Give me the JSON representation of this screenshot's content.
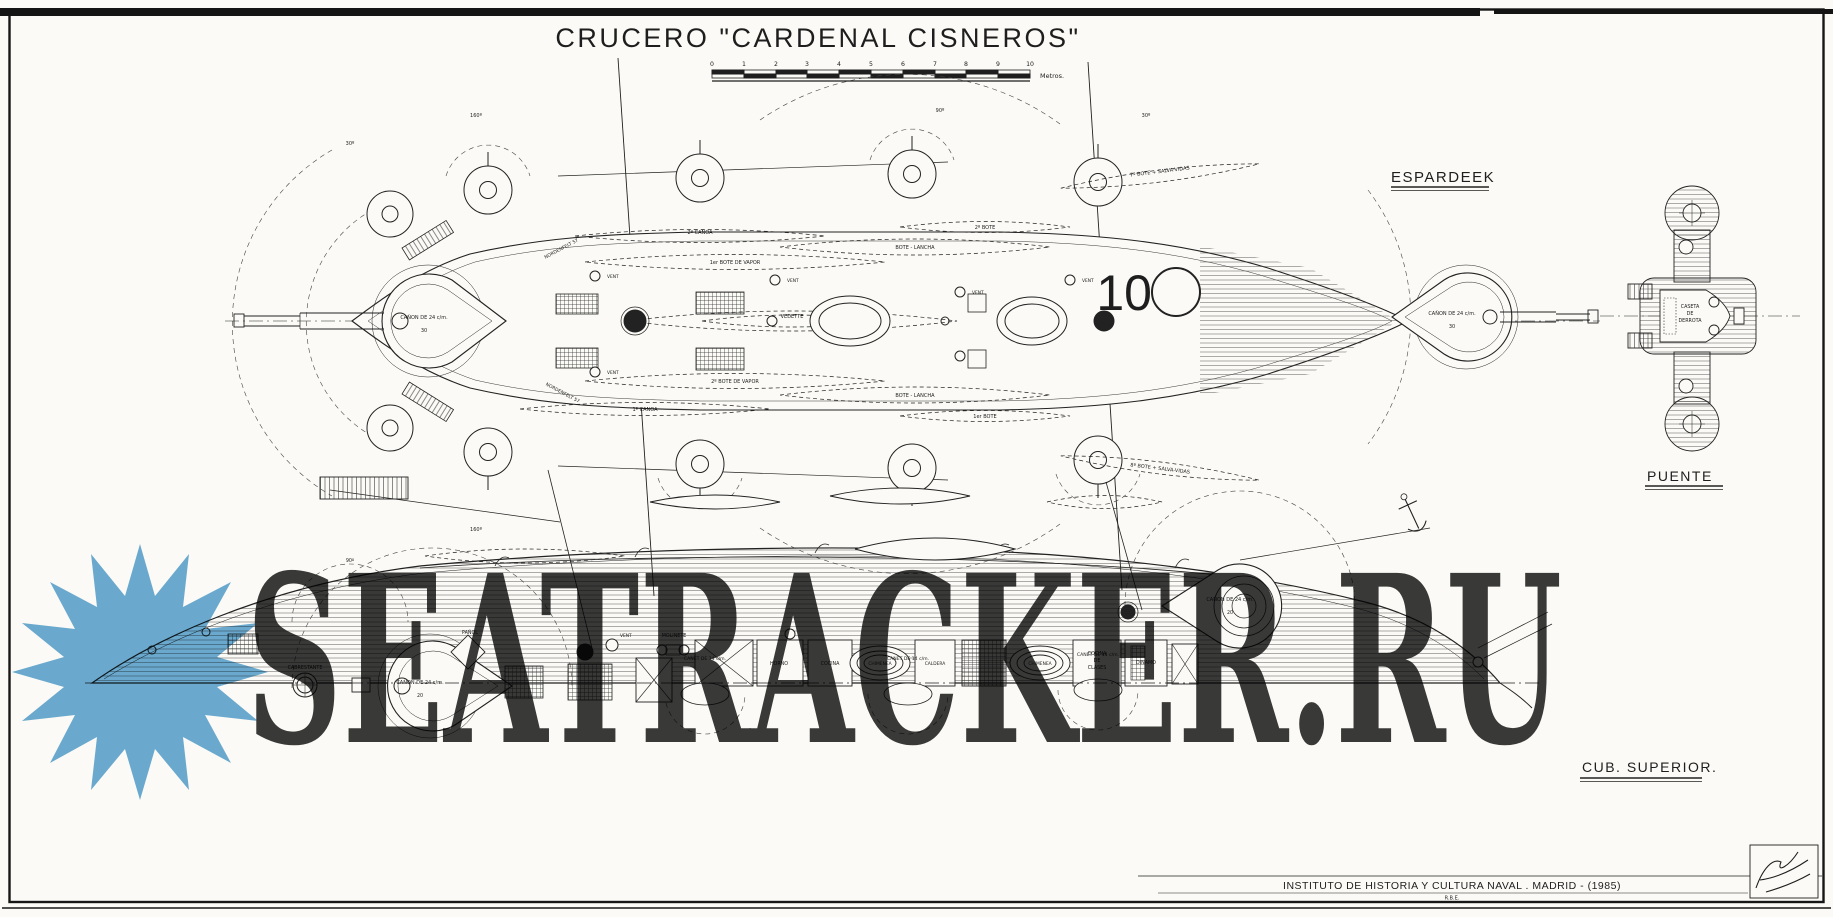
{
  "title": "CRUCERO \"CARDENAL CISNEROS\"",
  "scale_bar": {
    "ticks": [
      "0",
      "1",
      "2",
      "3",
      "4",
      "5",
      "6",
      "7",
      "8",
      "9",
      "10"
    ],
    "unit": "Metros."
  },
  "plan_labels": {
    "espardeek": "ESPARDEEK",
    "puente": "PUENTE",
    "cub_superior": "CUB. SUPERIOR."
  },
  "annotations": {
    "canon24": "CAÑON DE 24 c/m.",
    "g30": "30",
    "g20": "20",
    "canoa1": "1ª CANOA",
    "canoa2": "2ª CANOA",
    "botevapor1": "1er BOTE DE VAPOR",
    "botevapor2": "2º BOTE DE VAPOR",
    "vedette": "VEDETTE",
    "botelancha": "BOTE - LANCHA",
    "bote1": "1er BOTE",
    "bote2": "2º BOTE",
    "bote7": "7º BOTE + SALVA-VIDAS",
    "bote8": "8º BOTE + SALVA-VIDAS",
    "nordenfelt": "NORDENFELT 57",
    "vent": "VENT",
    "mark10": "10",
    "deg30": "30º",
    "deg90": "90º",
    "deg160": "160º",
    "caseta1": "CASETA",
    "caseta2": "DE",
    "caseta3": "DERROTA",
    "cabrestante": "CABRESTANTE",
    "panol": "PAÑOL",
    "molinete": "MOLINETE",
    "horno": "HORNO",
    "cocina": "COCINA",
    "chimenea": "CHIMENEA",
    "caldera": "CALDERA",
    "clases1": "COCINA",
    "clases2": "DE",
    "clases3": "CLASES",
    "dinamo": "DINAMO",
    "canet": "CANET DE 14 c/m."
  },
  "credit": {
    "institute": "INSTITUTO  DE  HISTORIA  Y  CULTURA  NAVAL . MADRID - (1985)",
    "ref": "R.B.E."
  },
  "watermark": {
    "text": "SEATRACKER.RU",
    "color": "#57a2d0"
  },
  "colors": {
    "paper": "#fbfaf6",
    "ink": "#1e1e1e"
  }
}
